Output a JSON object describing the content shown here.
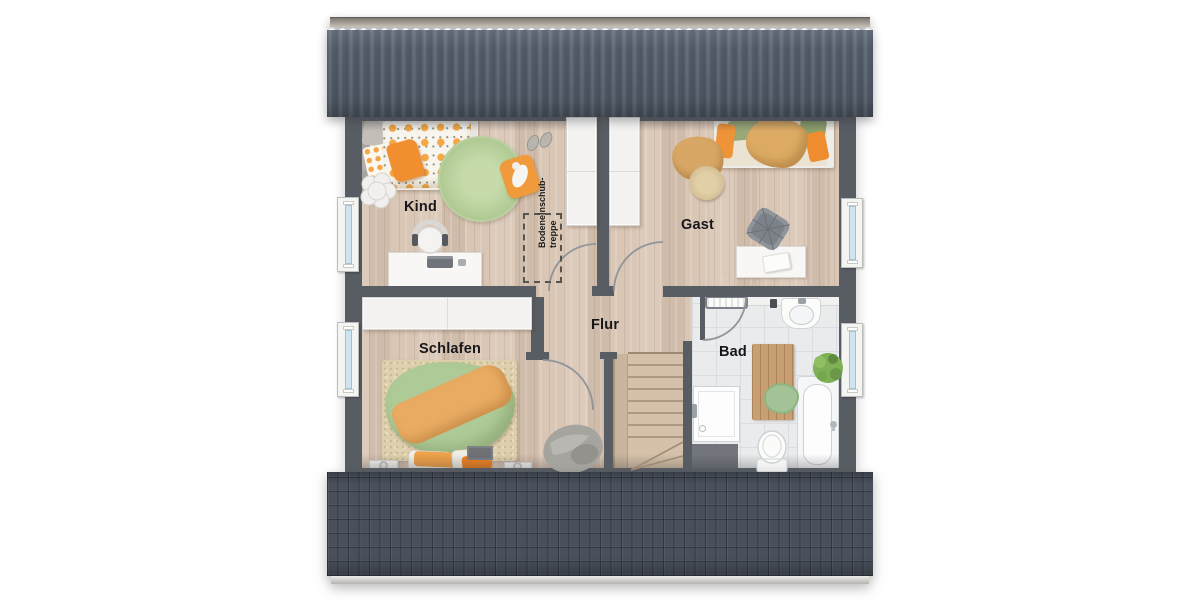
{
  "plan": {
    "type": "floor-plan",
    "floor": "attic-storey",
    "rooms": {
      "kind": {
        "label": "Kind"
      },
      "gast": {
        "label": "Gast"
      },
      "schlafen": {
        "label": "Schlafen"
      },
      "flur": {
        "label": "Flur"
      },
      "bad": {
        "label": "Bad"
      }
    },
    "attic_hatch": {
      "line1": "Bodeneinschub-",
      "line2": "treppe"
    },
    "features": [
      "staircase",
      "bathtub",
      "shower",
      "toilet",
      "sink",
      "two-beds",
      "double-bed",
      "desks",
      "wardrobes",
      "windows"
    ]
  },
  "palette": {
    "roof_top": "#57606d",
    "roof_bottom": "#49505b",
    "roof_ridge": "#c6c0b4",
    "wall": "#585d64",
    "floor_wood": "#d6c3b2",
    "floor_tile": "#e9ebed",
    "accent_orange": "#f09a3c",
    "accent_green": "#aecb97",
    "rug_green": "#b7cf9a",
    "stairs_wood": "#d5c1aa",
    "window_glass": "#cfe4ef",
    "furniture_white": "#f8f7f5",
    "label_color": "#17171a"
  }
}
